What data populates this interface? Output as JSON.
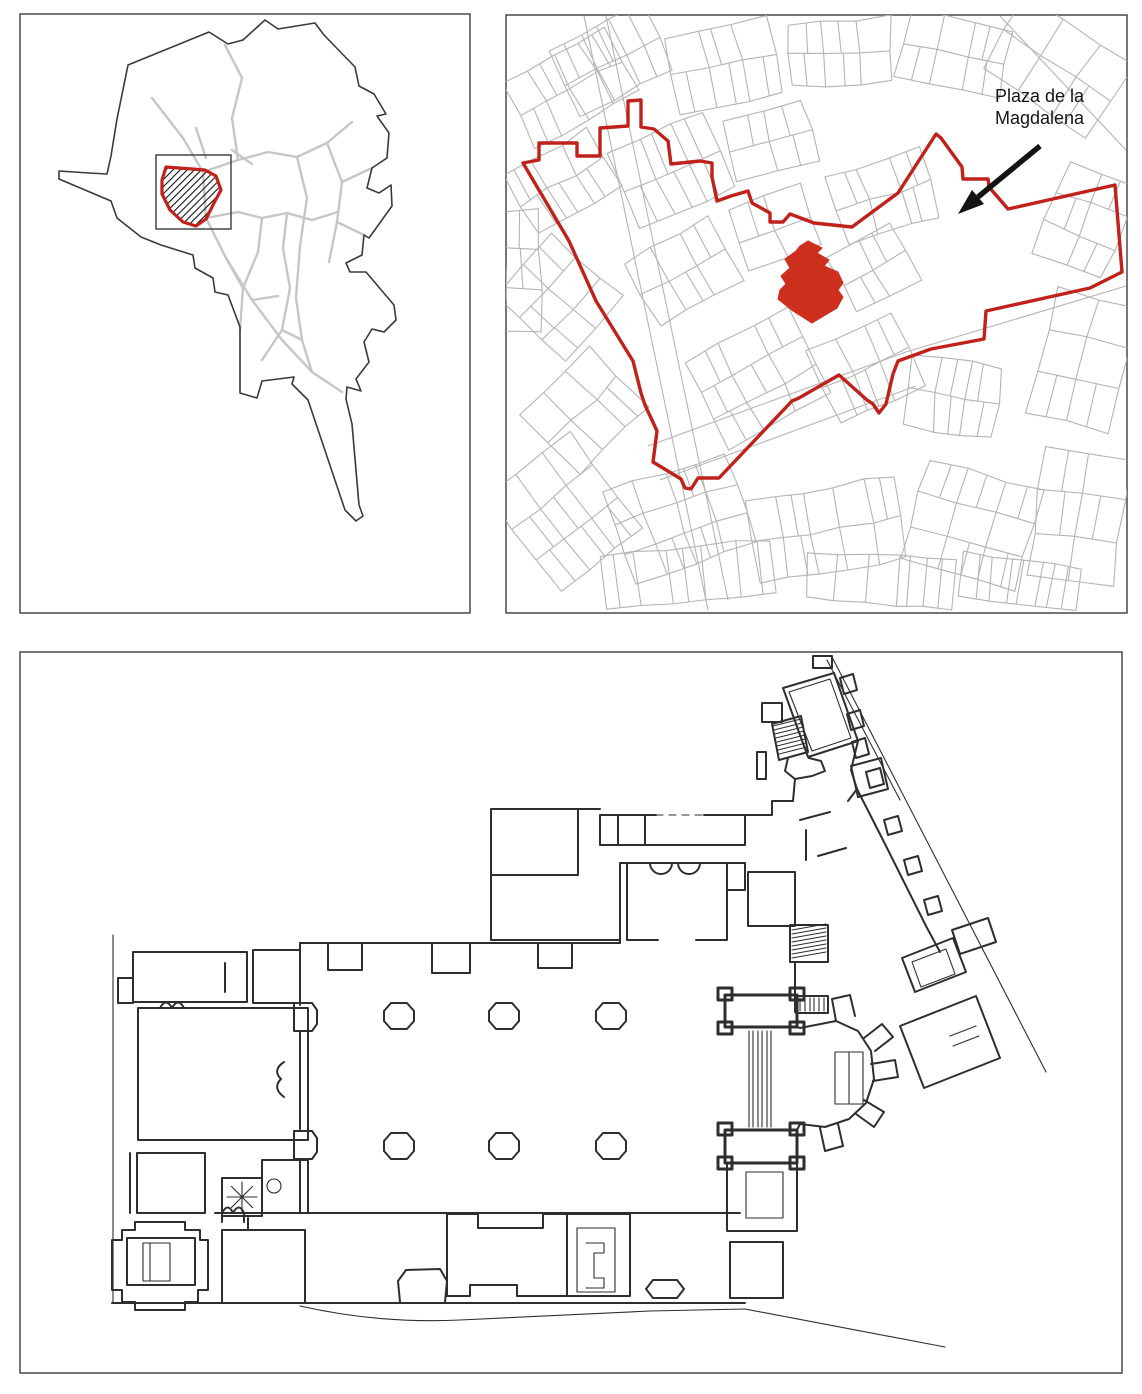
{
  "annotation": {
    "label": {
      "line1": "Plaza de la",
      "line2": "Magdalena"
    }
  },
  "colors": {
    "highlight": "#ce2f1f",
    "boundary": "#c0211a",
    "parcel": "#b4b4b4",
    "street": "#c6c6c6",
    "city": "#3a3a3a",
    "frame": "#3c3c3c",
    "ink": "#2e2e2e",
    "text": "#141414",
    "arrow": "#141414"
  }
}
